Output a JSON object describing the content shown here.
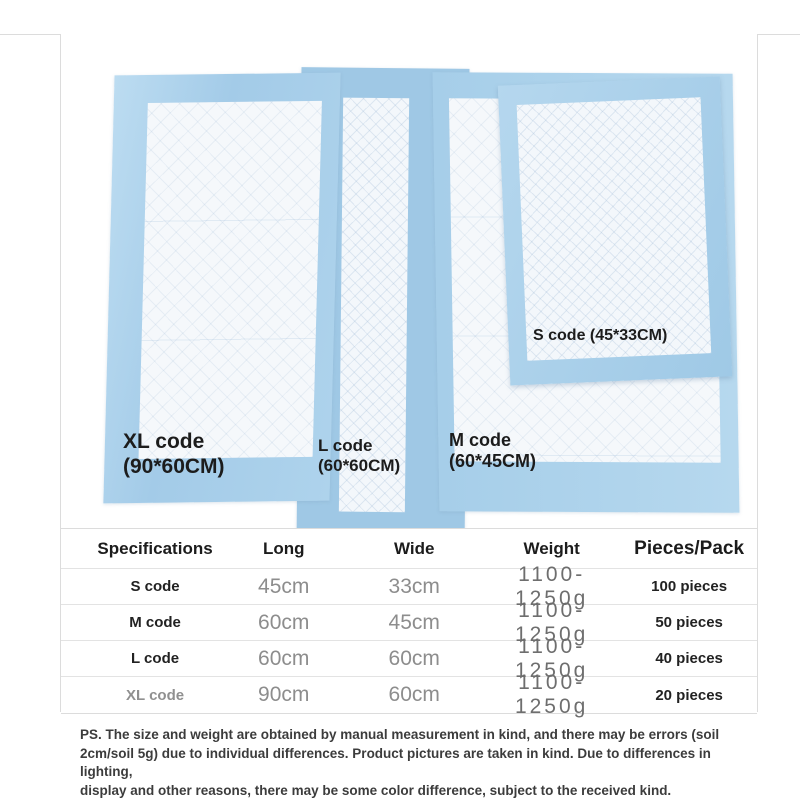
{
  "photo": {
    "labels": {
      "xl": {
        "line1": "XL code",
        "line2": "(90*60CM)"
      },
      "l": {
        "line1": "L code",
        "line2": "(60*60CM)"
      },
      "m": {
        "line1": "M code",
        "line2": "(60*45CM)"
      },
      "s": {
        "text": "S code (45*33CM)"
      }
    }
  },
  "table": {
    "columns": [
      "Specifications",
      "Long",
      "Wide",
      "Weight",
      "Pieces/Pack"
    ],
    "rows": [
      {
        "spec": "S code",
        "long": "45cm",
        "wide": "33cm",
        "weight": "1100-1250g",
        "pieces": "100 pieces"
      },
      {
        "spec": "M code",
        "long": "60cm",
        "wide": "45cm",
        "weight": "1100-1250g",
        "pieces": "50 pieces"
      },
      {
        "spec": "L code",
        "long": "60cm",
        "wide": "60cm",
        "weight": "1100-1250g",
        "pieces": "40 pieces"
      },
      {
        "spec": "XL code",
        "long": "90cm",
        "wide": "60cm",
        "weight": "1100-1250g",
        "pieces": "20 pieces"
      }
    ]
  },
  "notes": {
    "lines": [
      "PS. The size and weight are obtained by manual measurement in kind, and there may be errors (soil",
      "2cm/soil 5g) due to individual differences. Product pictures are taken in kind. Due to differences in lighting,",
      "display and other reasons, there may be some color difference, subject to the received kind."
    ]
  },
  "colors": {
    "line": "#dcdcdc",
    "text_dark": "#1c1c1c",
    "pad_blue": "#a8cfe9",
    "pad_blue_deep": "#9fc8e5",
    "pad_white": "#f5f8fb"
  }
}
